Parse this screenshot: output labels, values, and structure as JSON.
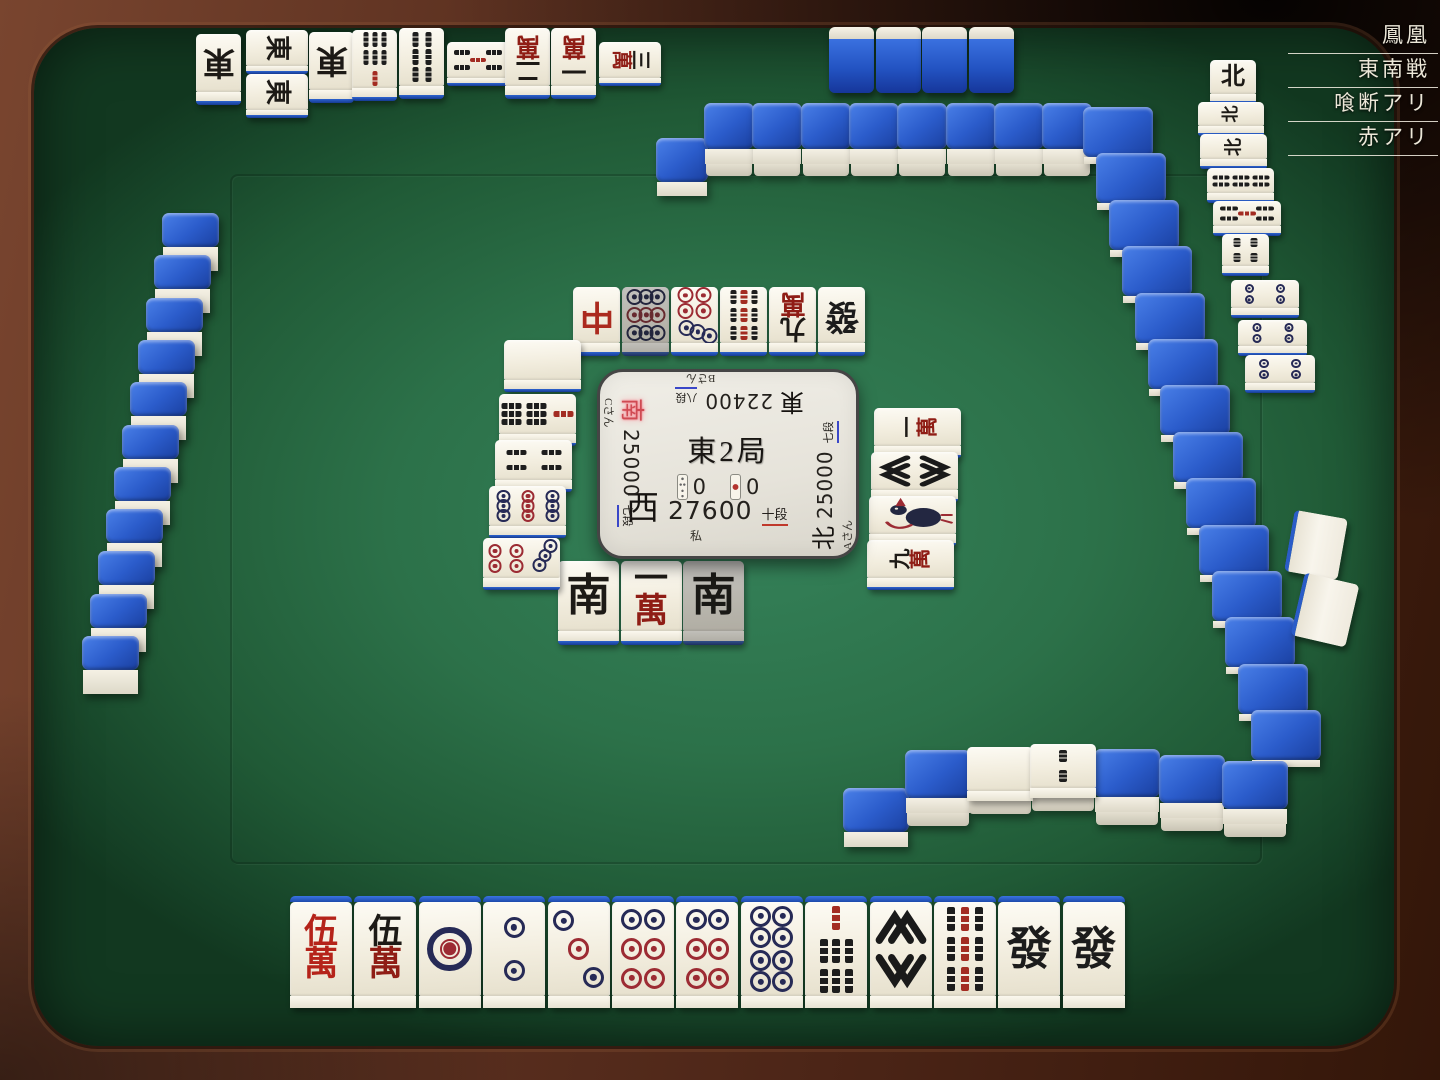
{
  "room": {
    "labels": [
      "鳳凰",
      "東南戦",
      "喰断アリ",
      "赤アリ"
    ]
  },
  "center_panel": {
    "round": "東2局",
    "riichi_sticks": "0",
    "honba": "0",
    "players": {
      "self": {
        "wind": "西",
        "score": "27600",
        "rank": "十段",
        "name": "私"
      },
      "right": {
        "wind": "北",
        "score": "25000",
        "rank": "七段",
        "name": "Aさん"
      },
      "top": {
        "wind": "東",
        "score": "22400",
        "rank": "八段",
        "name": "Bさん"
      },
      "left": {
        "wind": "南",
        "score": "25000",
        "rank": "七段",
        "name": "Cさん",
        "turn": true
      }
    }
  },
  "hand": [
    "5mr",
    "5m",
    "1p",
    "2p",
    "3p",
    "6p",
    "6p",
    "8p",
    "7s",
    "8s",
    "9s",
    "hatsu",
    "hatsu"
  ],
  "discards": {
    "self": [
      {
        "t": "nan"
      },
      {
        "t": "1m"
      },
      {
        "t": "nan",
        "gray": true
      }
    ],
    "top": [
      {
        "t": "chun"
      },
      {
        "t": "9p",
        "gray": true
      },
      {
        "t": "7p"
      },
      {
        "t": "9s"
      },
      {
        "t": "9m"
      },
      {
        "t": "hatsu"
      }
    ],
    "left": [
      {
        "t": "haku"
      },
      {
        "t": "7s"
      },
      {
        "t": "4s"
      },
      {
        "t": "9p"
      },
      {
        "t": "7p"
      }
    ],
    "right": [
      {
        "t": "1m"
      },
      {
        "t": "8s"
      },
      {
        "t": "1s"
      },
      {
        "t": "9m"
      }
    ]
  },
  "melds": {
    "top": [
      {
        "t": "ton"
      },
      {
        "t": "ton"
      },
      {
        "t": "ton"
      },
      {
        "t": "ton"
      },
      {
        "t": "7s"
      },
      {
        "t": "6s"
      },
      {
        "t": "5s"
      },
      {
        "t": "2m"
      },
      {
        "t": "1m"
      },
      {
        "t": "3m"
      }
    ],
    "right": [
      {
        "t": "pei"
      },
      {
        "t": "pei"
      },
      {
        "t": "pei"
      },
      {
        "t": "6s"
      },
      {
        "t": "5s"
      },
      {
        "t": "4s"
      },
      {
        "t": "4p"
      },
      {
        "t": "4p"
      },
      {
        "t": "4p"
      }
    ]
  },
  "opponent_hands": {
    "top_tiles": 4,
    "right_tiles": 2
  },
  "walls": {
    "top_stacks": 8,
    "top_single": 1,
    "right_stacks": 14,
    "left_tiles": 11,
    "dead_wall": [
      {
        "layers": 1,
        "top": "back"
      },
      {
        "layers": 2,
        "top": "back"
      },
      {
        "layers": 2,
        "top": "haku"
      },
      {
        "layers": 2,
        "top": "2s"
      },
      {
        "layers": 2,
        "top": "back"
      },
      {
        "layers": 2,
        "top": "back"
      },
      {
        "layers": 2,
        "top": "back"
      }
    ]
  },
  "dora_indicators": [
    "haku",
    "2s"
  ],
  "colors": {
    "felt": "#2c7149",
    "wood": "#5f3322",
    "tile_face": "#f2edde",
    "tile_back": "#2456c0",
    "man_red": "#8f1d15",
    "pin_navy": "#262a56",
    "pin_red": "#9c2b33",
    "accent_red": "#b3342e",
    "rank_blue": "#3a47c8"
  }
}
